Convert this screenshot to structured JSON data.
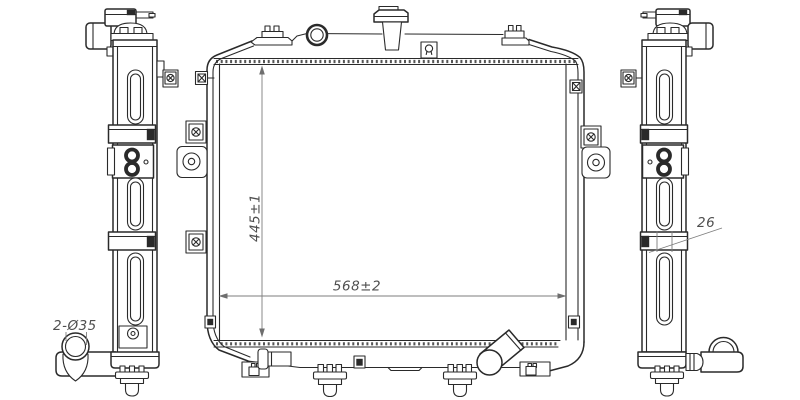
{
  "drawing": {
    "subject": "radiator-assembly-technical-drawing",
    "views": {
      "left_side": "left side view",
      "front": "front view",
      "right_side": "right side view"
    },
    "dimensions": {
      "core_height": "445±1",
      "core_width": "568±2",
      "clamp_width": "26",
      "outlet_ports": "2-Ø35"
    },
    "colors": {
      "line": "#2a2a2a",
      "dimension": "#7d7d7d",
      "background": "#ffffff"
    }
  }
}
